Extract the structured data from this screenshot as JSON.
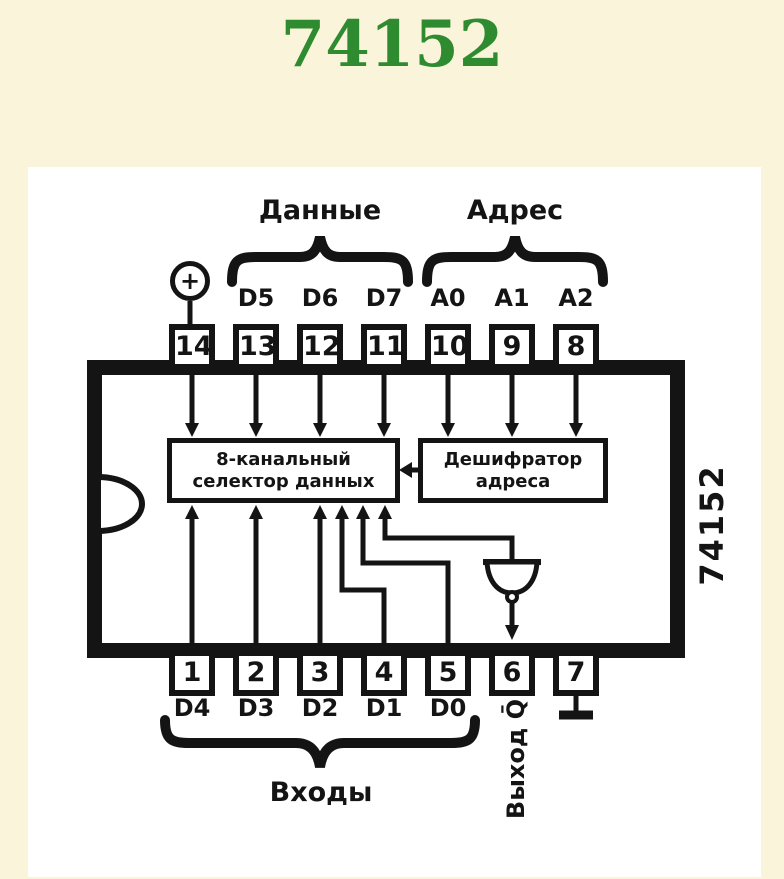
{
  "page": {
    "title": "74152",
    "colors": {
      "background": "#faf4da",
      "panel": "#ffffff",
      "ink": "#141414",
      "title_green": "#2e8b2f"
    }
  },
  "diagram": {
    "side_part_number": "74152",
    "power_symbol": "+",
    "groups": {
      "data": "Данные",
      "address": "Адрес",
      "inputs": "Входы"
    },
    "blocks": {
      "selector_line1": "8-канальный",
      "selector_line2": "селектор данных",
      "decoder_line1": "Дешифратор",
      "decoder_line2": "адреса"
    },
    "output_label": "Выход Q̄",
    "pins_top": [
      {
        "number": "14",
        "signal": ""
      },
      {
        "number": "13",
        "signal": "D5"
      },
      {
        "number": "12",
        "signal": "D6"
      },
      {
        "number": "11",
        "signal": "D7"
      },
      {
        "number": "10",
        "signal": "A0"
      },
      {
        "number": "9",
        "signal": "A1"
      },
      {
        "number": "8",
        "signal": "A2"
      }
    ],
    "pins_bottom": [
      {
        "number": "1",
        "signal": "D4"
      },
      {
        "number": "2",
        "signal": "D3"
      },
      {
        "number": "3",
        "signal": "D2"
      },
      {
        "number": "4",
        "signal": "D1"
      },
      {
        "number": "5",
        "signal": "D0"
      },
      {
        "number": "6",
        "signal": ""
      },
      {
        "number": "7",
        "signal": ""
      }
    ]
  }
}
